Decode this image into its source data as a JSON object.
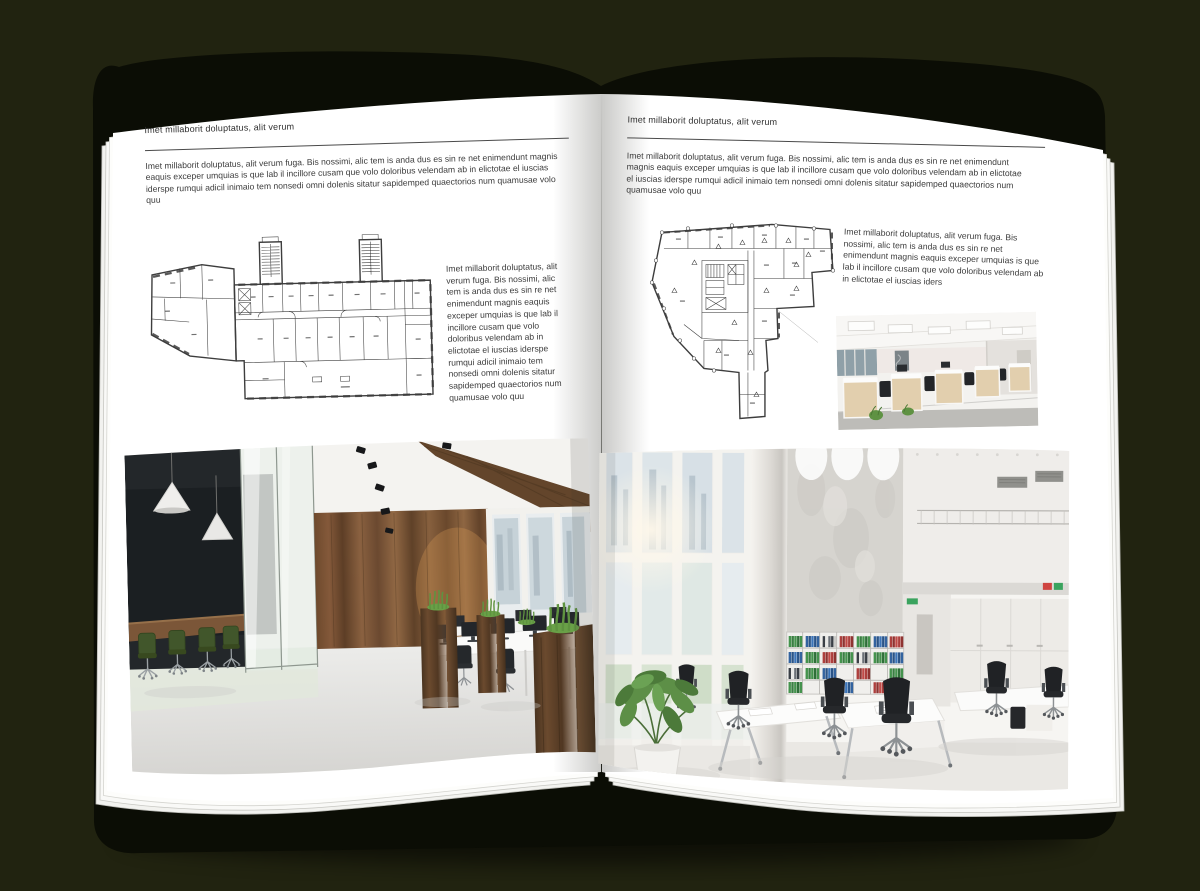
{
  "canvas": {
    "background_color": "#212310",
    "cover_color": "#0b0d05",
    "page_color": "#ffffff"
  },
  "left_page": {
    "header": "Imet millaborit doluptatus, alit verum",
    "body": "Imet millaborit doluptatus, alit verum fuga. Bis nossimi, alic tem is anda dus es sin re net enimendunt magnis eaquis exceper umquias is que lab il incillore cusam que volo doloribus velendam ab in elictotae el iuscias iderspe rumqui adicil inimaio tem nonsedi omni dolenis sitatur sapidemped quaectorios num quamusae volo quu",
    "side_text": "Imet millaborit doluptatus, alit verum fuga. Bis nossimi, alic tem is anda dus es sin re net enimendunt magnis eaquis exceper umquias is que lab il incillore cusam que volo doloribus velendam ab in elictotae el iuscias iderspe rumqui adicil inimaio tem nonsedi omni dolenis sitatur sapidemped quaectorios num quamusae volo quu",
    "floor_plan_name": "office-building-floor-plan-wide",
    "photo_name": "office-interior-dark-wood-photo"
  },
  "right_page": {
    "header": "Imet millaborit doluptatus, alit verum",
    "body": "Imet millaborit doluptatus, alit verum fuga. Bis nossimi, alic tem is anda dus es sin re net enimendunt magnis eaquis exceper umquias is que lab il incillore cusam que volo doloribus velendam ab in elictotae el iuscias iderspe rumqui adicil inimaio tem nonsedi omni dolenis sitatur sapidemped quaectorios num quamusae volo quu",
    "side_text": "Imet millaborit doluptatus, alit verum fuga. Bis nossimi, alic tem is anda dus es sin re net enimendunt magnis eaquis exceper umquias is que lab il incillore cusam que volo doloribus velendam ab in elictotae el iuscias iders",
    "floor_plan_name": "office-building-floor-plan-irregular",
    "small_photo_name": "office-workstations-photo",
    "photo_name": "office-interior-loft-photo"
  }
}
